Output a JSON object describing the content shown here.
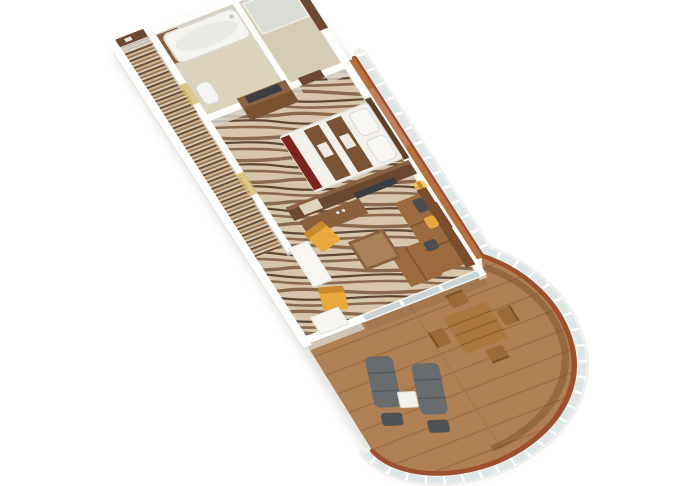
{
  "scene": {
    "type": "3d-floorplan-render",
    "subject": "cruise-ship suite isometric floor plan with curved wrap-around veranda",
    "view": "axonometric, suite runs diagonally from upper-left entrance to lower-right balcony tip",
    "rooms": [
      "entrance-corridor",
      "bathroom-with-tub",
      "shower-room",
      "bedroom",
      "living-room",
      "balcony-veranda",
      "bedroom-balcony-nook"
    ],
    "furniture": [
      "entrance-door",
      "hall-closet",
      "bathtub",
      "toilet",
      "shower-tray",
      "bed-with-runners-and-red-throw",
      "bedroom-tv-dresser",
      "bedroom-door",
      "media-partition-with-tv",
      "vanity-desk-with-mirror",
      "wall-lamp",
      "wall-artwork",
      "l-shaped-sofa",
      "coffee-table",
      "yellow-armchair-1",
      "yellow-armchair-2",
      "white-pillar",
      "white-sideboard",
      "sliding-glass-doors",
      "outdoor-dining-table",
      "outdoor-chairs-x4",
      "sun-lounger-1",
      "sun-lounger-2",
      "lounger-footstool-1",
      "lounger-footstool-2",
      "outdoor-side-table",
      "curved-railing-with-glass-panels"
    ]
  },
  "colors": {
    "background": "#ffffff",
    "wall": "#fdfdfc",
    "wall_shadow": "#d8d4cd",
    "silhouette_shadow": "#ccc9c2",
    "corridor_stripe_dark": "#6b4a33",
    "corridor_stripe_cream": "#cbb594",
    "corridor_stripe_mid": "#96714f",
    "corridor_stripe_light": "#d9cbb4",
    "carpet_cream": "#d7c6ac",
    "carpet_brown": "#8a6a4e",
    "carpet_dark": "#5f4733",
    "bath_floor": "#dcd3bd",
    "bath_tile": "#cfc2a4",
    "shower_floor": "#d5ccb5",
    "fixture_white": "#f4f4f0",
    "tub_inner": "#e9ebe7",
    "door_brown": "#6d4730",
    "lit_floor": "#d9be70",
    "closet_wood": "#8a5f3e",
    "partition_wood": "#6b4830",
    "partition_top": "#8a6142",
    "desk_wood": "#8a5f3c",
    "dresser_wood": "#7a5231",
    "tv_screen": "#3a3e42",
    "mirror": "#ded5c0",
    "bed_white": "#f3f1ec",
    "bed_runner": "#7a5234",
    "bed_red": "#7d2420",
    "headboard_wood": "#5e3f2a",
    "sofa_back": "#7a4e2c",
    "sofa_body": "#9c6a3f",
    "pillow_gray": "#4b4d4f",
    "pillow_yellow": "#e8a93c",
    "chair_yellow": "#e9a93c",
    "chair_yellow_back": "#c98a2e",
    "coffee_table_wood": "#8a6240",
    "coffee_table_top": "#a9825a",
    "lamp_glow": "#f5c654",
    "art_frame": "#7d3322",
    "glass_door_pane": "#c9d4d6",
    "deck_wood": "#b08055",
    "deck_plank_line": "#9a6d44",
    "deck_rim": "#9c5030",
    "deck_arc_shadow": "rgba(92,52,28,0.30)",
    "railing_white": "#f1efe9",
    "railing_glass": "#dde6e8",
    "ledge_wood": "#b5713f",
    "recess_terracotta": "#c08064",
    "outdoor_table_wood": "#a9773f",
    "outdoor_chair_wood": "#9a6a38",
    "lounger_gray": "#686c6e",
    "lounger_frame": "#4f5254",
    "side_table_white": "#f4f2ec",
    "pillar_white": "#f7f6f3",
    "sideboard_white": "#f6f5f1"
  }
}
